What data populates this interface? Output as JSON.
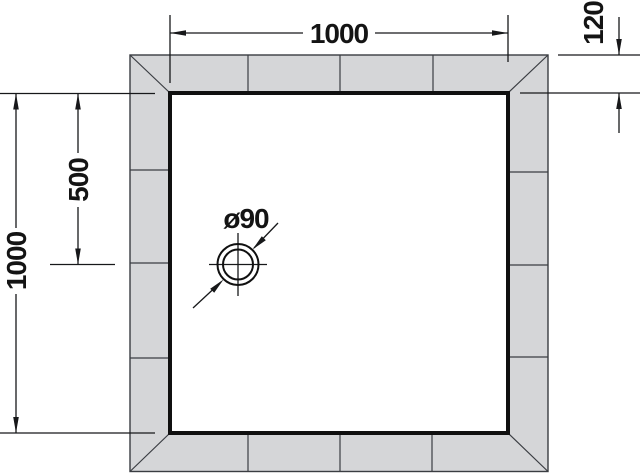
{
  "drawing": {
    "labels": {
      "top_width": "1000",
      "surround_depth": "120",
      "left_height": "1000",
      "drain_offset": "500",
      "drain_diameter": "ø90"
    },
    "colors": {
      "background": "#ffffff",
      "tile_fill": "#d5d6d8",
      "line": "#3a3d42",
      "ink": "#141414"
    }
  }
}
